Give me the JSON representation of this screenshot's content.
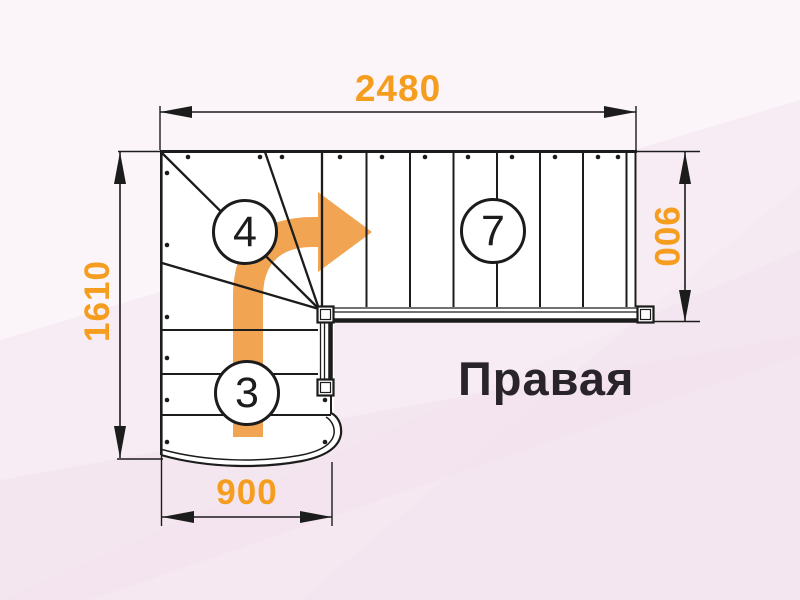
{
  "diagram": {
    "type_label": "Правая",
    "dimensions": {
      "top_width": "2480",
      "left_height": "1610",
      "right_width": "900",
      "bottom_width": "900"
    },
    "step_counts": {
      "winder_steps": "4",
      "upper_flight_steps": "7",
      "lower_flight_steps": "3"
    },
    "colors": {
      "dimension_orange": "#F59D1E",
      "arrow_orange": "#F1A452",
      "line_black": "#1c1c1c",
      "background_pink": "#f6ebf3"
    },
    "icons": [
      "direction-arrow"
    ]
  }
}
